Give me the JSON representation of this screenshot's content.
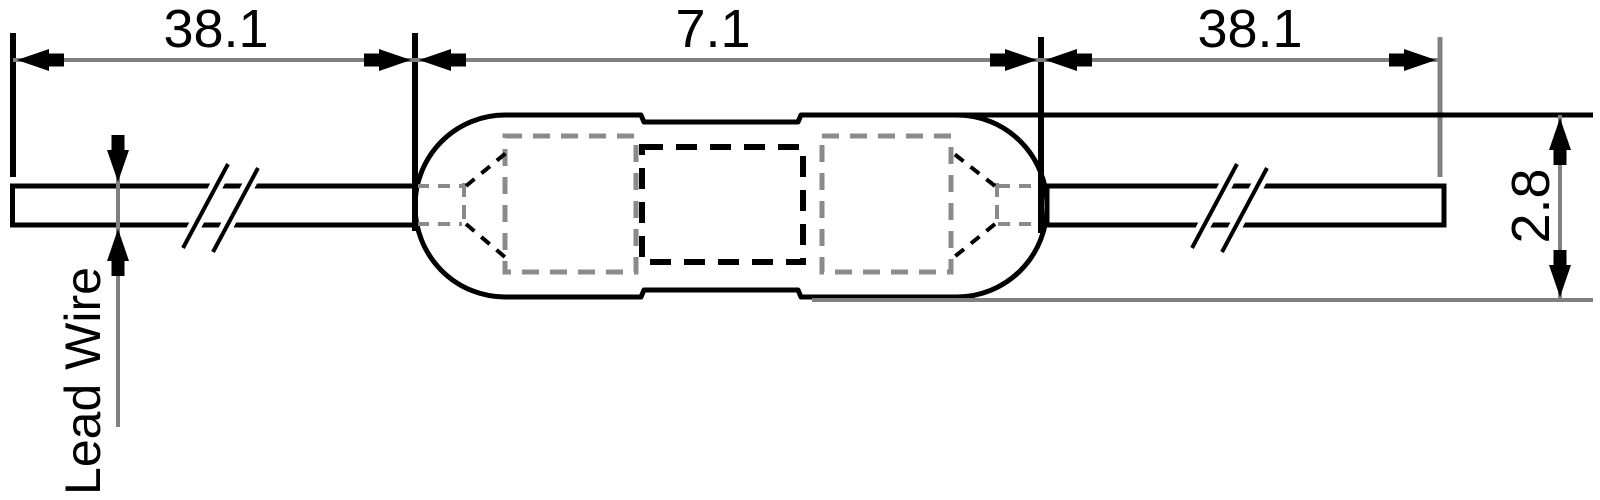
{
  "dimensions": {
    "lead_left": "38.1",
    "body_length": "7.1",
    "lead_right": "38.1",
    "body_diameter": "2.8"
  },
  "labels": {
    "lead_wire": "Lead Wire"
  },
  "colors": {
    "line": "#000000",
    "dimension_line": "#808080",
    "hidden_detail": "#8a8a8a",
    "background": "#ffffff"
  }
}
